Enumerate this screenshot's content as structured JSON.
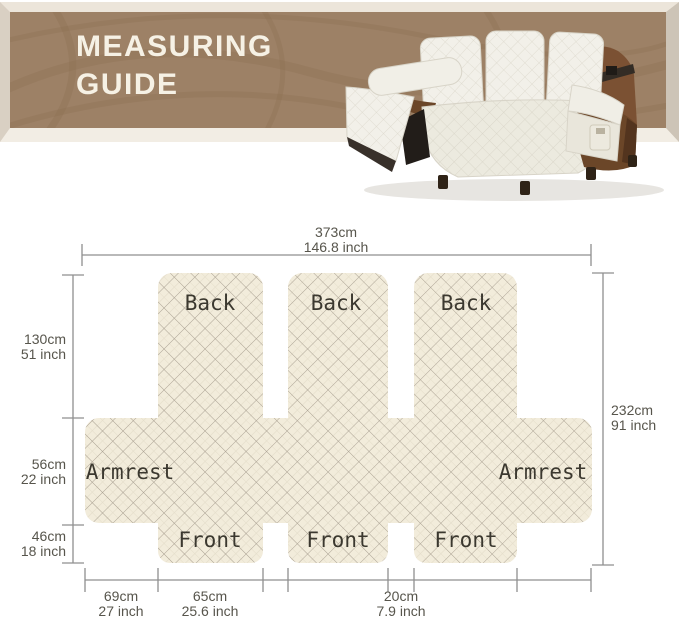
{
  "header": {
    "title_line1": "MEASURING",
    "title_line2": "GUIDE"
  },
  "labels": {
    "back": "Back",
    "armrest": "Armrest",
    "front": "Front"
  },
  "dims": {
    "top": {
      "cm": "373cm",
      "inch": "146.8 inch"
    },
    "right": {
      "cm": "232cm",
      "inch": "91 inch"
    },
    "left": [
      {
        "cm": "130cm",
        "inch": "51 inch"
      },
      {
        "cm": "56cm",
        "inch": "22 inch"
      },
      {
        "cm": "46cm",
        "inch": "18 inch"
      }
    ],
    "bottom": [
      {
        "cm": "69cm",
        "inch": "27 inch"
      },
      {
        "cm": "65cm",
        "inch": "25.6 inch"
      },
      {
        "cm": "20cm",
        "inch": "7.9 inch"
      }
    ]
  },
  "colors": {
    "banner_brown": "#9d8166",
    "banner_text": "#f6f1e5",
    "cover_cream": "#f2ecdb",
    "quilt_line": "#a89f90",
    "dimension_line": "#8f8f8f",
    "leather_brown": "#6b4628"
  }
}
